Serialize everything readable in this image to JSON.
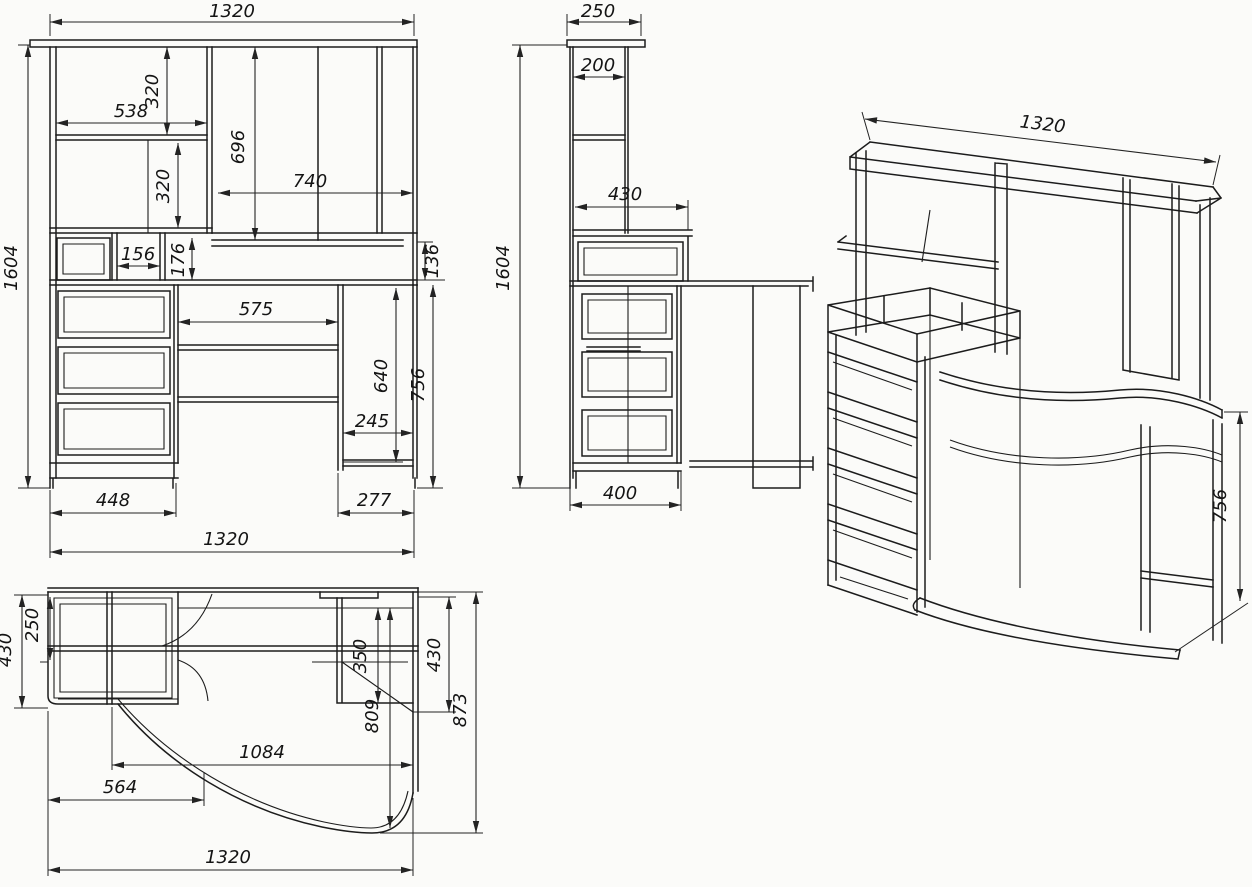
{
  "page": {
    "background": "#fbfbf9",
    "line_color": "#1c1c1c",
    "text_color": "#141414"
  },
  "views": {
    "front": {
      "dims": {
        "width_top": "1320",
        "shelf_width": "538",
        "upper_shelf_height": "320",
        "inner_shelf_height": "320",
        "niche_height": "696",
        "niche_width": "740",
        "cubby_width": "156",
        "cubby_height": "176",
        "rail_height": "136",
        "height_overall": "1604",
        "knee_width": "575",
        "knee_height": "640",
        "desk_height": "756",
        "foot_inset": "245",
        "pedestal_width": "448",
        "leg_width": "277",
        "width_bottom": "1320"
      }
    },
    "side": {
      "dims": {
        "top_depth": "250",
        "shelf_depth": "200",
        "work_depth": "430",
        "height_overall": "1604",
        "cabinet_depth": "400"
      }
    },
    "plan": {
      "dims": {
        "return_depth": "430",
        "back_depth": "250",
        "bay_depth": "350",
        "right_depth": "430",
        "curve_depth": "809",
        "depth_overall": "873",
        "span": "1084",
        "cabinet_span": "564",
        "width_overall": "1320"
      }
    },
    "iso": {
      "dims": {
        "width": "1320",
        "desk_height": "756"
      }
    }
  }
}
